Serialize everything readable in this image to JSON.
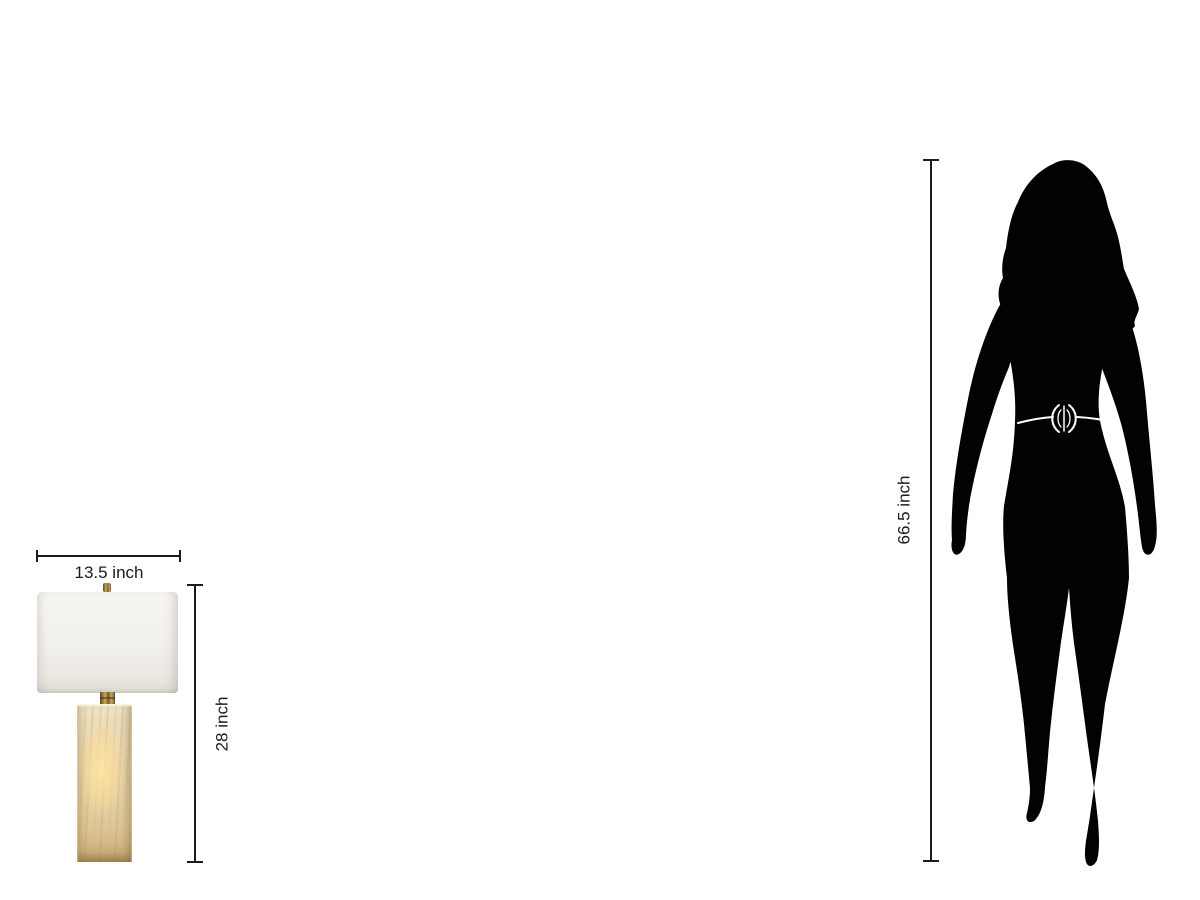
{
  "colors": {
    "background": "#ffffff",
    "annotation": "#1c1c1c",
    "silhouette": "#020202",
    "belt": "#ffffff",
    "shade": "#f1efeb",
    "brass": "#a8854a",
    "stone": "#e7d6ae",
    "stone_glow": "#ffe4a0"
  },
  "annotations": {
    "lamp_width_label": "13.5 inch",
    "lamp_height_label": "28 inch",
    "person_height_label": "66.5 inch"
  }
}
